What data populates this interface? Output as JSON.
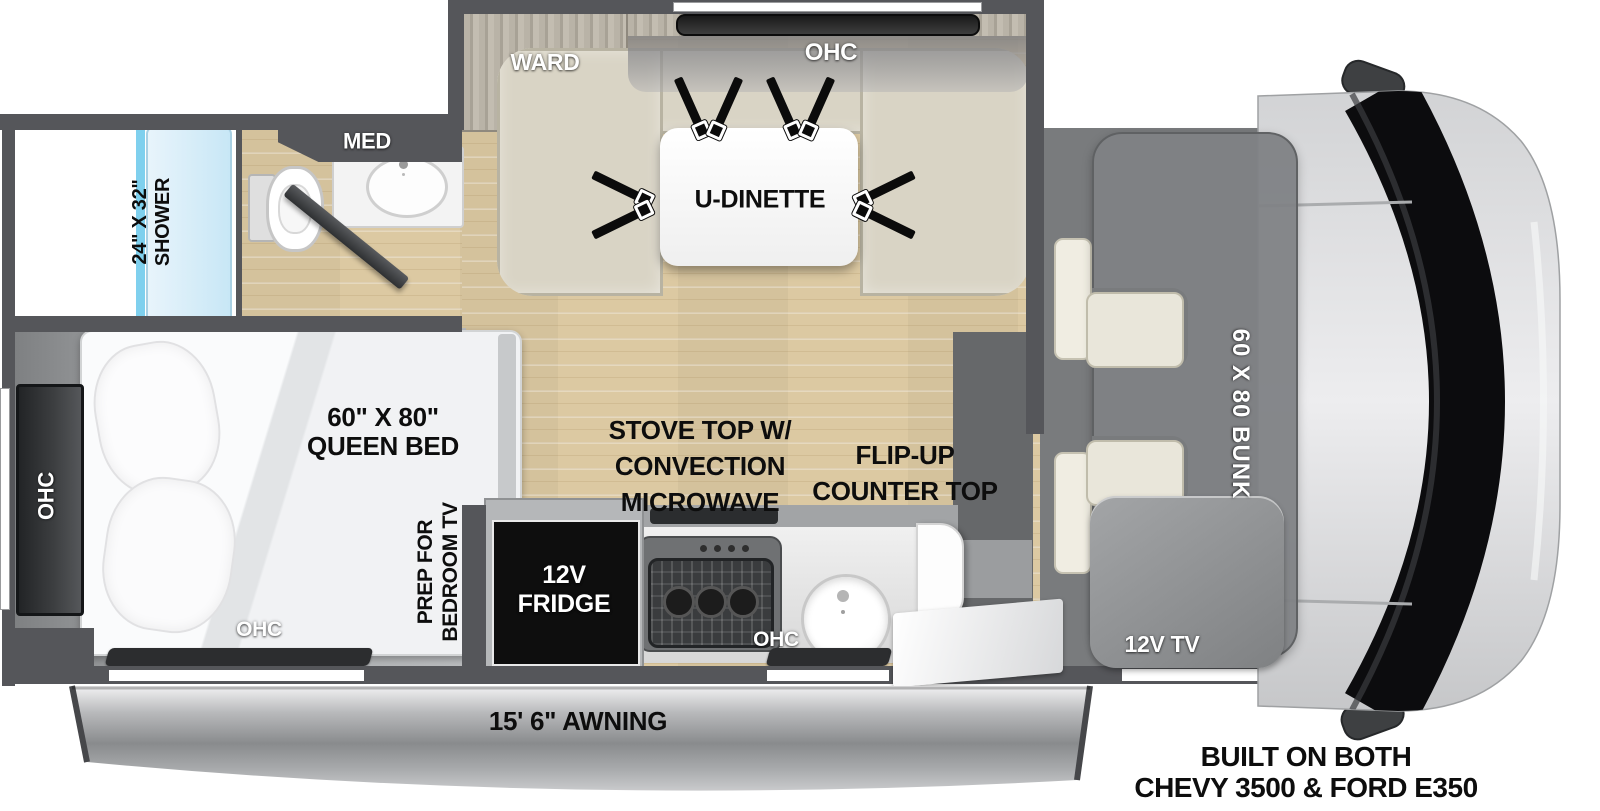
{
  "diagram": {
    "type": "rv-floorplan-top-view",
    "chassis_note_line1": "BUILT ON BOTH",
    "chassis_note_line2": "CHEVY 3500 & FORD E350",
    "awning_label": "15' 6\" AWNING"
  },
  "bathroom": {
    "shower_dim": "24\" X 32\"",
    "shower_word": "SHOWER",
    "med_label": "MED"
  },
  "wardrobe_label": "WARD",
  "dinette": {
    "ohc_label": "OHC",
    "table_label": "U-DINETTE"
  },
  "bedroom": {
    "bed_dim": "60\" X 80\"",
    "bed_word": "QUEEN BED",
    "ohc_side_label": "OHC",
    "ohc_foot_label": "OHC",
    "tv_prep_line1": "PREP FOR",
    "tv_prep_line2": "BEDROOM TV"
  },
  "kitchen": {
    "stove_line1": "STOVE TOP W/",
    "stove_line2": "CONVECTION",
    "stove_line3": "MICROWAVE",
    "flip_line1": "FLIP-UP",
    "flip_line2": "COUNTER TOP",
    "fridge_line1": "12V",
    "fridge_line2": "FRIDGE",
    "ohc_label": "OHC"
  },
  "cab": {
    "bunk_label": "60 X 80 BUNK",
    "tv_label": "12V TV"
  },
  "colors": {
    "wall": "#55565a",
    "wood_floor": "#dcc9a2",
    "bedroom_floor": "#a8aaac",
    "cab_floor": "#797b7d",
    "seat_beige": "#d9d4c5",
    "shower_blue": "#cfe9f6",
    "glass_blue": "#7fd0ee",
    "awning_silver": "#a9abad",
    "label_black": "#0d0d0d",
    "label_white": "#ffffff"
  }
}
